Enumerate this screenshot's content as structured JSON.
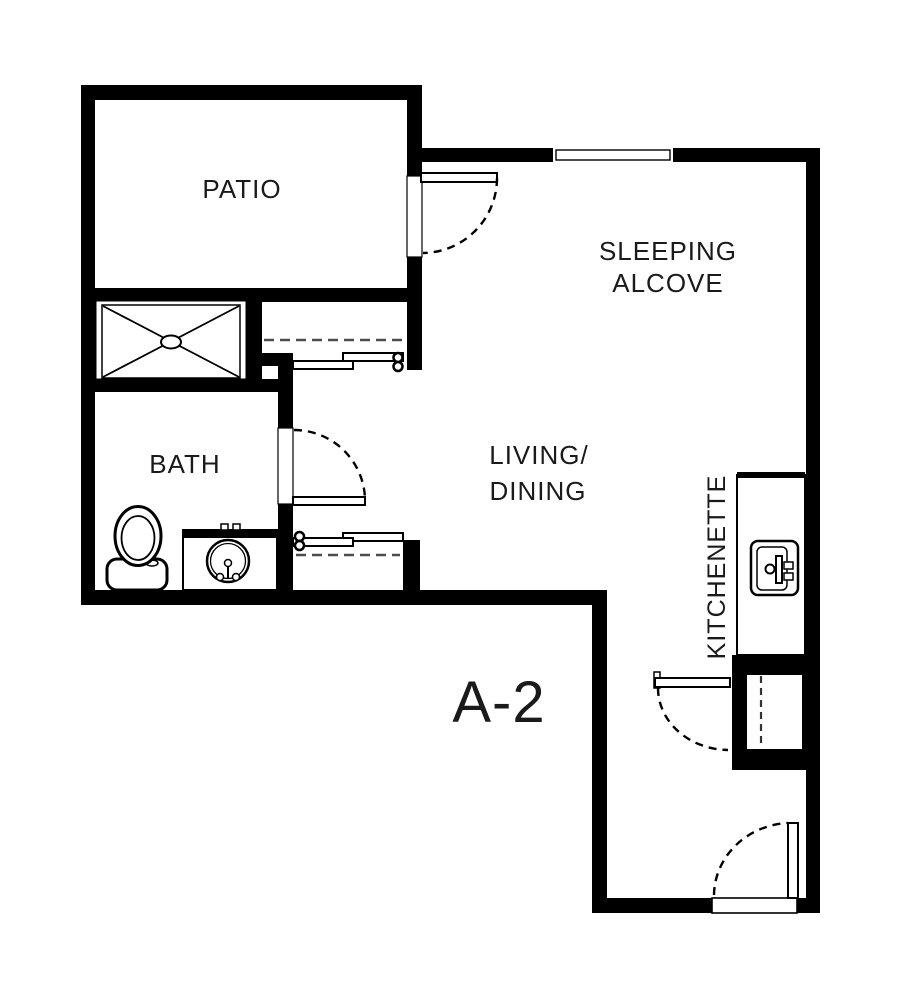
{
  "plan": {
    "unit_label": "A-2",
    "background": "#ffffff",
    "wall_color": "#000000",
    "text_color": "#1a1a1a",
    "closet_rod_dash_color": "#4d4d4d",
    "rooms": {
      "patio": {
        "label": "PATIO"
      },
      "sleeping_alcove": {
        "line1": "SLEEPING",
        "line2": "ALCOVE"
      },
      "bath": {
        "label": "BATH"
      },
      "living_dining": {
        "line1": "LIVING/",
        "line2": "DINING"
      },
      "kitchenette": {
        "label": "KITCHENETTE"
      }
    },
    "symbols": [
      "shower-pan",
      "toilet",
      "vanity-sink",
      "kitchen-sink",
      "kitchenette-counter",
      "window",
      "hinged-door-swing",
      "bypass-closet-doors",
      "closet-rod-dashed",
      "entry-door-threshold",
      "entry-closet"
    ]
  }
}
